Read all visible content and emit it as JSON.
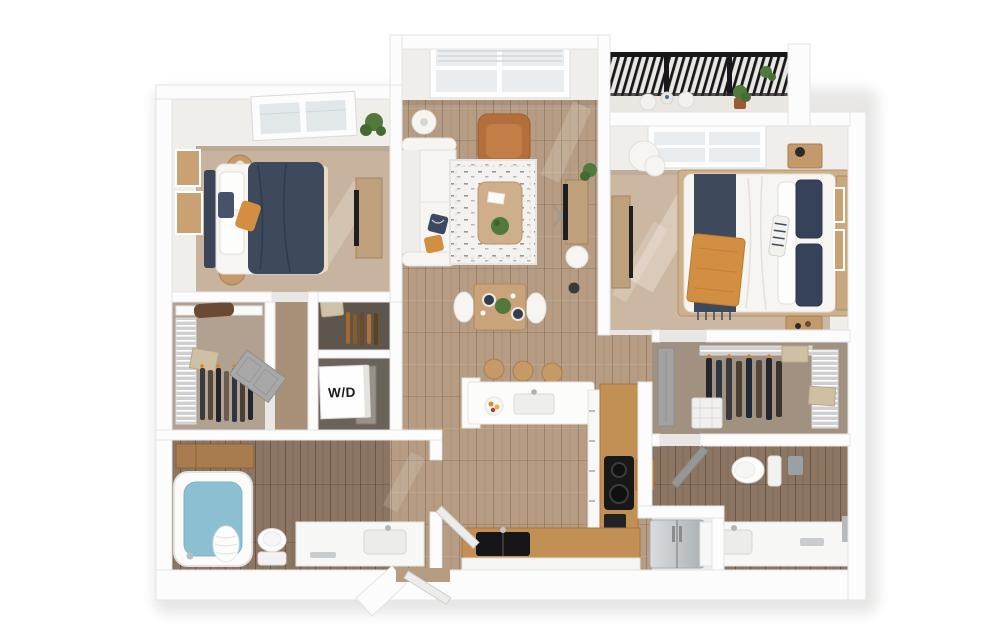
{
  "figure": {
    "type": "3d-floor-plan",
    "view": "top-down dollhouse render",
    "unit_layout": "2 bedroom / 2 bathroom apartment with balcony"
  },
  "labels": {
    "washer_dryer": "W/D"
  },
  "palette": {
    "wall": "#fcfcfc",
    "wallFace": "#f0eeeb",
    "carpetBedroom": "#c8b49e",
    "carpetBedroom2": "#ccb8a2",
    "carpetCloset": "#b0a190",
    "carpetCloset2": "#a09180",
    "carpetHall": "#a89078",
    "woodFloor": "#b59c82",
    "woodFloorBath": "#8c7663",
    "counterWood": "#c28f55",
    "cabinetWood": "#a97c50",
    "bedNavy": "#3e4a5c",
    "accentMustard": "#d28e41",
    "leatherTan": "#b26f3b",
    "tubWater": "#8dbfd3",
    "doorGray": "#a0a0a0",
    "plantGreen": "#51793b",
    "artFrameTan": "#c8a273",
    "railingBlack": "#17171c",
    "applianceSteel": "#c6c9cc"
  },
  "rooms": [
    {
      "id": "bedroom-1",
      "floor": "carpet"
    },
    {
      "id": "walk-in-closet-1",
      "floor": "carpet"
    },
    {
      "id": "hallway",
      "floor": "carpet"
    },
    {
      "id": "linen-closet",
      "floor": "carpet"
    },
    {
      "id": "laundry-closet",
      "floor": "carpet"
    },
    {
      "id": "bathroom-1",
      "floor": "wood"
    },
    {
      "id": "living-room",
      "floor": "wood"
    },
    {
      "id": "dining-area",
      "floor": "wood"
    },
    {
      "id": "kitchen",
      "floor": "wood"
    },
    {
      "id": "entry",
      "floor": "wood"
    },
    {
      "id": "balcony",
      "floor": "concrete"
    },
    {
      "id": "bedroom-2",
      "floor": "carpet"
    },
    {
      "id": "walk-in-closet-2",
      "floor": "carpet"
    },
    {
      "id": "bathroom-2",
      "floor": "wood"
    },
    {
      "id": "refrigerator-nook",
      "floor": "wood"
    }
  ],
  "furnishings": {
    "bedroom_1": [
      "queen bed with navy duvet",
      "two round nightstands",
      "wall art frames",
      "dresser with tv",
      "potted plant",
      "skylight window"
    ],
    "living_room": [
      "white sectional sofa",
      "cognac leather armchair",
      "speckled area rug",
      "wood coffee table",
      "tv console",
      "floor lamps",
      "large window"
    ],
    "dining_area": [
      "square wood table",
      "two white chairs",
      "place settings",
      "greenery centerpiece"
    ],
    "kitchen": [
      "peninsula with sink and 3 bar stools",
      "cooktop counter",
      "black double sink",
      "stainless refrigerator",
      "butcher block"
    ],
    "bathroom_1": [
      "soaking tub",
      "toilet",
      "single vanity",
      "wood linen cabinet"
    ],
    "bedroom_2": [
      "queen bed with navy and mustard layers",
      "two nightstands",
      "white lounge chair",
      "media console",
      "wall art",
      "window"
    ],
    "bathroom_2": [
      "toilet",
      "long vanity"
    ],
    "closets": [
      "wire shelving",
      "hanging clothes",
      "storage boxes",
      "laundry basket"
    ],
    "laundry_closet": [
      "stacked washer dryer cube"
    ],
    "balcony": [
      "metal railing",
      "bistro chairs",
      "potted plants"
    ]
  }
}
